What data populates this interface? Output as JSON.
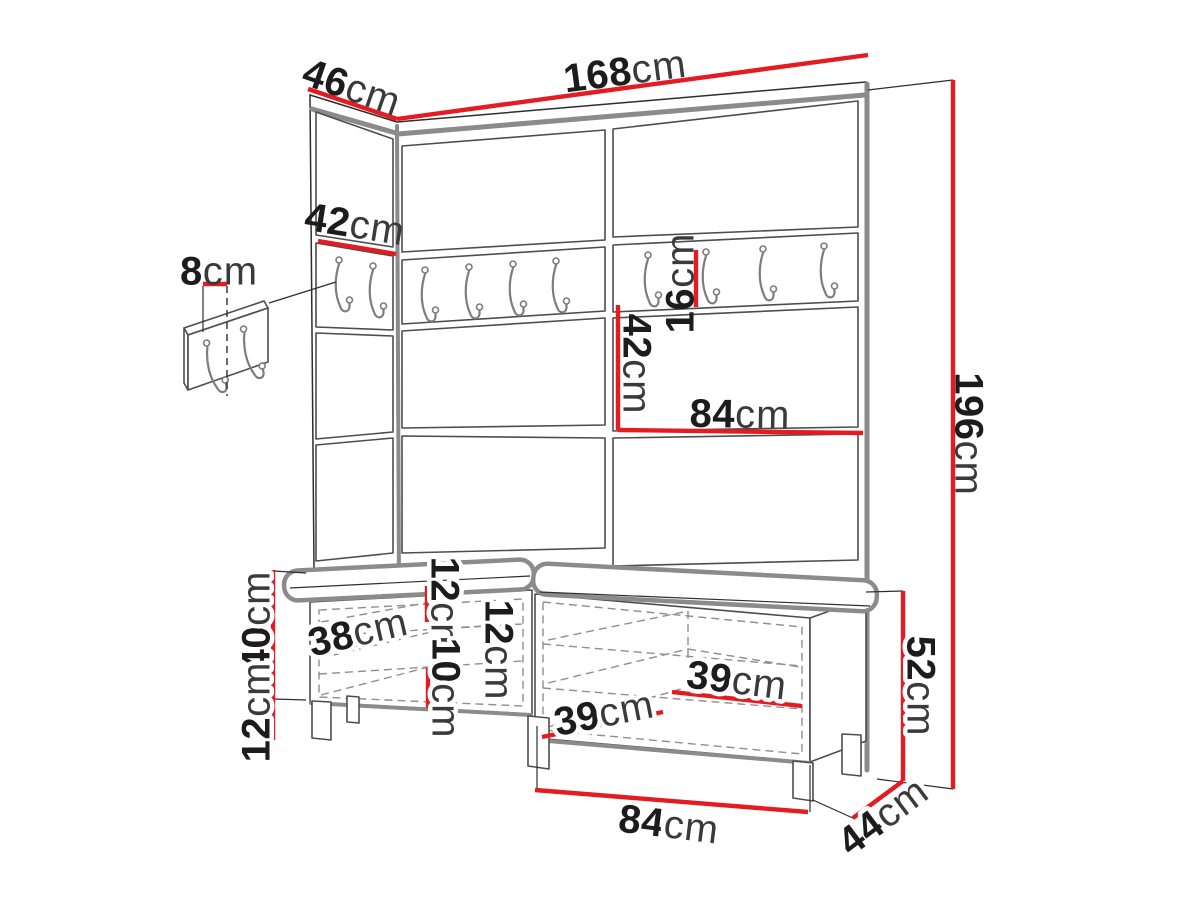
{
  "meta": {
    "background": "#ffffff",
    "accent_red": "#e51b22",
    "ink_color": "#1c1c1c",
    "drawing_type": "furniture dimension diagram"
  },
  "icons": {
    "coat_hook": "j-hook-with-screw-dots"
  },
  "dimensions": {
    "top_depth": {
      "value": "46",
      "unit": "cm"
    },
    "top_width": {
      "value": "168",
      "unit": "cm"
    },
    "left_panel_width": {
      "value": "42",
      "unit": "cm"
    },
    "hook_strip_width": {
      "value": "8",
      "unit": "cm"
    },
    "rail_height": {
      "value": "16",
      "unit": "cm"
    },
    "mid_panel_height": {
      "value": "42",
      "unit": "cm"
    },
    "mid_panel_width": {
      "value": "84",
      "unit": "cm"
    },
    "total_height": {
      "value": "196",
      "unit": "cm"
    },
    "bench_body_height": {
      "value": "40",
      "unit": "cm"
    },
    "bench_leg_height": {
      "value": "12",
      "unit": "cm"
    },
    "bench_inner_depth": {
      "value": "38",
      "unit": "cm"
    },
    "shelf_gap_top": {
      "value": "12",
      "unit": "cm"
    },
    "shelf_gap_bottom": {
      "value": "10",
      "unit": "cm"
    },
    "shelf_gap_mid": {
      "value": "12",
      "unit": "cm"
    },
    "inner_width_left": {
      "value": "39",
      "unit": "cm"
    },
    "inner_width_right": {
      "value": "39",
      "unit": "cm"
    },
    "bench_total_height": {
      "value": "52",
      "unit": "cm"
    },
    "bench_half_width": {
      "value": "84",
      "unit": "cm"
    },
    "bench_depth": {
      "value": "44",
      "unit": "cm"
    }
  }
}
